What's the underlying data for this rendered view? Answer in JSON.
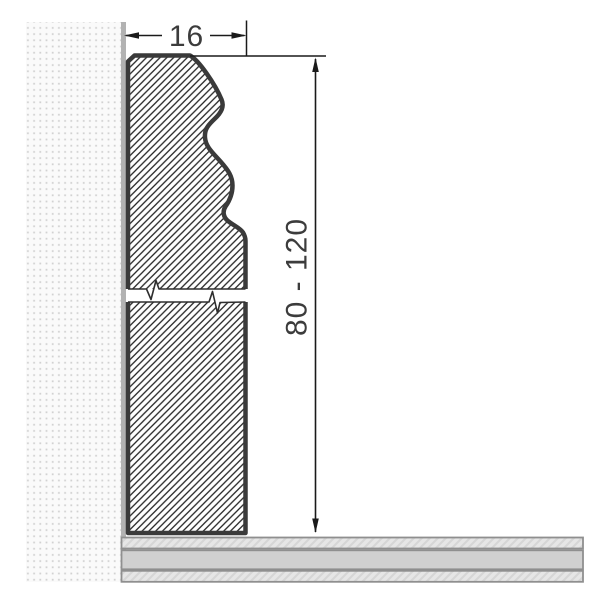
{
  "drawing": {
    "width_dimension": {
      "label": "16"
    },
    "height_dimension": {
      "label": "80 - 120"
    }
  },
  "colors": {
    "background": "#ffffff",
    "profile_outline": "#3a3a3a",
    "profile_hatch": "#282828",
    "break_line": "#2e2e2e",
    "wall_background": "#fafafa",
    "wall_dots": "#d2d2d2",
    "wall_strip": "#b2b2b2",
    "floor_light": "#e6e6e6",
    "floor_hatch_line": "#d6d6d6",
    "floor_mid": "#d0d0d0",
    "floor_border": "#8f8f8f",
    "dimension_line": "#1a1a1a",
    "dimension_text": "#3c3c3c"
  }
}
